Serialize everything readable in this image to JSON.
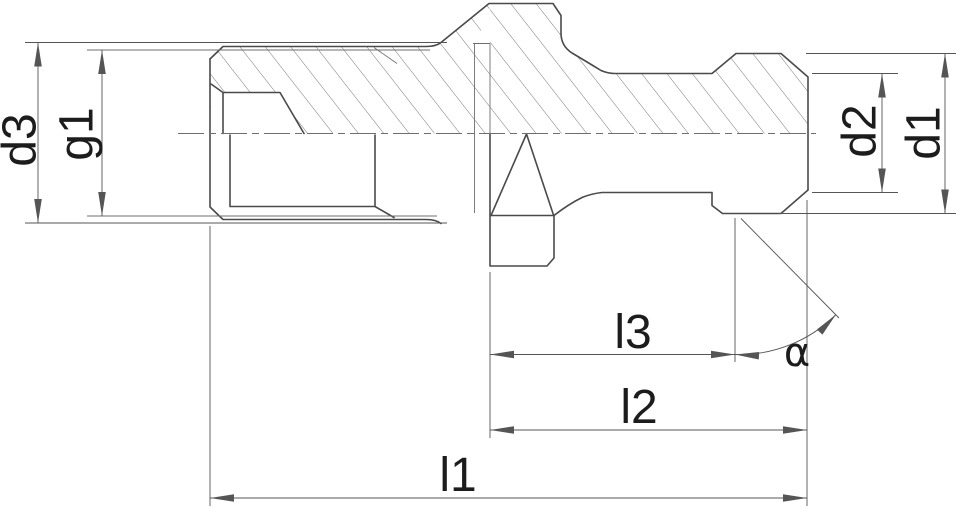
{
  "drawing": {
    "labels": {
      "d3": "d3",
      "g1": "g1",
      "d2": "d2",
      "d1": "d1",
      "l3": "l3",
      "l2": "l2",
      "l1": "l1",
      "alpha": "α"
    },
    "colors": {
      "background": "#ffffff",
      "line": "#4a4a4a",
      "thin_line": "#6f6f6f",
      "dimension": "#555555",
      "text": "#1c1c1c"
    }
  }
}
